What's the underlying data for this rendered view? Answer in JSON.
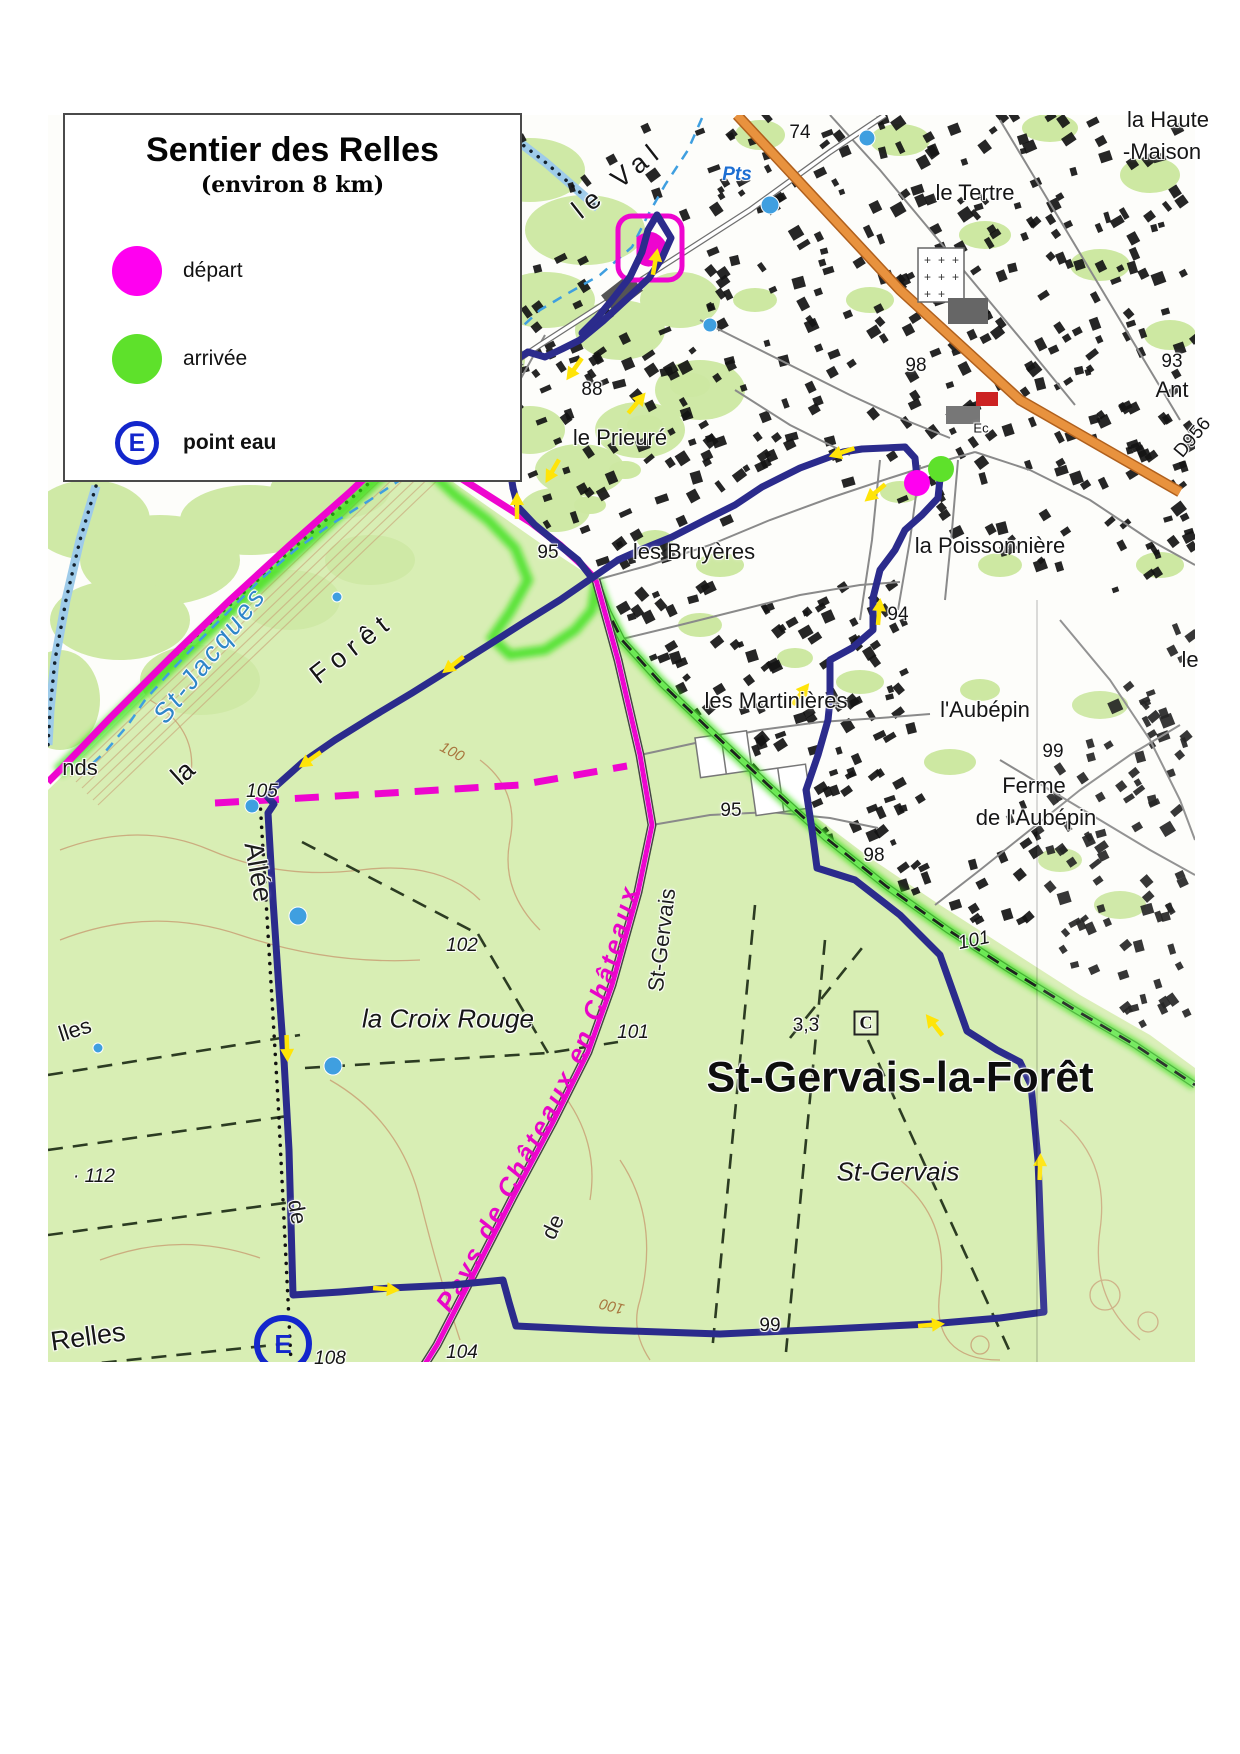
{
  "legend": {
    "title": "Sentier des Relles",
    "subtitle": "(environ 8 km)",
    "items": [
      {
        "symbol": "circle",
        "color": "#ff00f0",
        "label": "départ"
      },
      {
        "symbol": "circle",
        "color": "#5ee12b",
        "label": "arrivée"
      },
      {
        "symbol": "ring-E",
        "color": "#1326cc",
        "letter": "E",
        "label": "point eau"
      }
    ]
  },
  "map": {
    "colors": {
      "route": "#2b2b8c",
      "trail_magenta": "#ee05cf",
      "highlight_green": "#2fe00a",
      "forest": "#d8eeb4",
      "road_orange": "#e8923e",
      "water_blue": "#3f9fe0",
      "arrow_yellow": "#ffe408",
      "depart": "#ff00f0",
      "arrivee": "#5ee12b",
      "water_point_blue": "#1326cc"
    },
    "magenta_label": "Pays de Châteaux en Châteaux",
    "labels": [
      {
        "text": "le Val",
        "x": 618,
        "y": 180,
        "rot": -38,
        "cls": "place-lg ls"
      },
      {
        "text": "Pts",
        "x": 737,
        "y": 175,
        "rot": 0,
        "cls": "water"
      },
      {
        "text": "le Tertre",
        "x": 975,
        "y": 193,
        "rot": 0,
        "cls": "place"
      },
      {
        "text": "la Haute",
        "x": 1168,
        "y": 120,
        "rot": 0,
        "cls": "place"
      },
      {
        "text": "-Maison",
        "x": 1162,
        "y": 152,
        "rot": 0,
        "cls": "place"
      },
      {
        "text": "74",
        "x": 800,
        "y": 133,
        "rot": 0,
        "cls": "spot"
      },
      {
        "text": "98",
        "x": 916,
        "y": 366,
        "rot": 0,
        "cls": "spot"
      },
      {
        "text": "93",
        "x": 1172,
        "y": 362,
        "rot": 0,
        "cls": "spot"
      },
      {
        "text": "Ant",
        "x": 1172,
        "y": 390,
        "rot": 0,
        "cls": "place"
      },
      {
        "text": "D956",
        "x": 1193,
        "y": 438,
        "rot": -50,
        "cls": "spot"
      },
      {
        "text": "Ec",
        "x": 981,
        "y": 428,
        "rot": 0,
        "cls": "tiny"
      },
      {
        "text": "le Prieuré",
        "x": 620,
        "y": 438,
        "rot": 0,
        "cls": "place"
      },
      {
        "text": "88",
        "x": 592,
        "y": 390,
        "rot": 0,
        "cls": "spot"
      },
      {
        "text": "les Bruyères",
        "x": 694,
        "y": 552,
        "rot": 0,
        "cls": "place"
      },
      {
        "text": "95",
        "x": 548,
        "y": 553,
        "rot": 0,
        "cls": "spot"
      },
      {
        "text": "la Poissonnière",
        "x": 990,
        "y": 546,
        "rot": 0,
        "cls": "place"
      },
      {
        "text": "les Martinières",
        "x": 776,
        "y": 701,
        "rot": 0,
        "cls": "place"
      },
      {
        "text": "94",
        "x": 898,
        "y": 615,
        "rot": 0,
        "cls": "spot"
      },
      {
        "text": "l'Aubépin",
        "x": 985,
        "y": 710,
        "rot": 0,
        "cls": "place"
      },
      {
        "text": "99",
        "x": 1053,
        "y": 752,
        "rot": 0,
        "cls": "spot"
      },
      {
        "text": "Ferme",
        "x": 1034,
        "y": 786,
        "rot": 0,
        "cls": "place"
      },
      {
        "text": "de l'Aubépin",
        "x": 1036,
        "y": 818,
        "rot": 0,
        "cls": "place"
      },
      {
        "text": "98",
        "x": 874,
        "y": 856,
        "rot": 0,
        "cls": "spot"
      },
      {
        "text": "95",
        "x": 731,
        "y": 811,
        "rot": 0,
        "cls": "spot"
      },
      {
        "text": "101",
        "x": 974,
        "y": 941,
        "rot": -12,
        "cls": "spot-i"
      },
      {
        "text": "St-Gervais",
        "x": 662,
        "y": 940,
        "rot": -83,
        "cls": "roadname"
      },
      {
        "text": "de",
        "x": 553,
        "y": 1227,
        "rot": -65,
        "cls": "roadname"
      },
      {
        "text": "la Croix Rouge",
        "x": 448,
        "y": 1019,
        "rot": 0,
        "cls": "place-i"
      },
      {
        "text": "101",
        "x": 633,
        "y": 1033,
        "rot": 0,
        "cls": "spot-i"
      },
      {
        "text": "3,3",
        "x": 806,
        "y": 1026,
        "rot": 0,
        "cls": "spot"
      },
      {
        "text": "C",
        "x": 866,
        "y": 1023,
        "rot": 0,
        "cls": "cbox"
      },
      {
        "text": "St-Gervais-la-Forêt",
        "x": 900,
        "y": 1078,
        "rot": 0,
        "cls": "town"
      },
      {
        "text": "St-Gervais",
        "x": 898,
        "y": 1172,
        "rot": 0,
        "cls": "place-i"
      },
      {
        "text": "St-Jacques",
        "x": 210,
        "y": 655,
        "rot": -52,
        "cls": "water-lg"
      },
      {
        "text": "Forêt",
        "x": 352,
        "y": 648,
        "rot": -38,
        "cls": "place-lg ls"
      },
      {
        "text": "la",
        "x": 183,
        "y": 773,
        "rot": -42,
        "cls": "place-lg"
      },
      {
        "text": "nds",
        "x": 80,
        "y": 768,
        "rot": 0,
        "cls": "place"
      },
      {
        "text": "105",
        "x": 262,
        "y": 792,
        "rot": 0,
        "cls": "spot-i"
      },
      {
        "text": "Allée",
        "x": 258,
        "y": 872,
        "rot": 80,
        "cls": "roadname-lg"
      },
      {
        "text": "102",
        "x": 462,
        "y": 946,
        "rot": 0,
        "cls": "spot-i"
      },
      {
        "text": "· 112",
        "x": 94,
        "y": 1177,
        "rot": 0,
        "cls": "spot-i"
      },
      {
        "text": "lles",
        "x": 75,
        "y": 1030,
        "rot": -18,
        "cls": "place"
      },
      {
        "text": "de",
        "x": 297,
        "y": 1212,
        "rot": 80,
        "cls": "roadname"
      },
      {
        "text": "Relles",
        "x": 88,
        "y": 1337,
        "rot": -8,
        "cls": "place-lg"
      },
      {
        "text": "108",
        "x": 330,
        "y": 1359,
        "rot": 0,
        "cls": "spot-i"
      },
      {
        "text": "104",
        "x": 462,
        "y": 1353,
        "rot": 0,
        "cls": "spot-i"
      },
      {
        "text": "100",
        "x": 612,
        "y": 1306,
        "rot": 195,
        "cls": "contour"
      },
      {
        "text": "99",
        "x": 770,
        "y": 1326,
        "rot": 0,
        "cls": "spot"
      },
      {
        "text": "100",
        "x": 452,
        "y": 752,
        "rot": 28,
        "cls": "contour"
      },
      {
        "text": "le",
        "x": 1190,
        "y": 660,
        "rot": 0,
        "cls": "place"
      }
    ],
    "route": {
      "color": "#2b2b8c",
      "segments": [
        [
          [
            905,
            447
          ],
          [
            862,
            449
          ],
          [
            843,
            452
          ],
          [
            800,
            468
          ],
          [
            762,
            487
          ],
          [
            735,
            505
          ],
          [
            705,
            520
          ],
          [
            672,
            537
          ],
          [
            645,
            548
          ],
          [
            618,
            560
          ],
          [
            592,
            578
          ],
          [
            560,
            600
          ],
          [
            523,
            623
          ],
          [
            487,
            646
          ],
          [
            452,
            668
          ],
          [
            412,
            693
          ],
          [
            372,
            717
          ],
          [
            335,
            740
          ],
          [
            303,
            762
          ],
          [
            266,
            795
          ],
          [
            274,
            804
          ],
          [
            268,
            813
          ],
          [
            273,
            900
          ],
          [
            279,
            990
          ],
          [
            284,
            1060
          ],
          [
            289,
            1150
          ],
          [
            293,
            1295
          ],
          [
            340,
            1292
          ],
          [
            390,
            1288
          ],
          [
            452,
            1285
          ],
          [
            503,
            1280
          ],
          [
            509,
            1302
          ],
          [
            516,
            1326
          ],
          [
            600,
            1330
          ],
          [
            720,
            1334
          ],
          [
            830,
            1329
          ],
          [
            930,
            1324
          ],
          [
            1000,
            1318
          ],
          [
            1044,
            1312
          ],
          [
            1041,
            1240
          ],
          [
            1038,
            1160
          ],
          [
            1031,
            1085
          ],
          [
            1020,
            1062
          ],
          [
            997,
            1050
          ],
          [
            967,
            1031
          ],
          [
            940,
            955
          ],
          [
            900,
            915
          ],
          [
            855,
            880
          ],
          [
            817,
            868
          ],
          [
            812,
            830
          ],
          [
            806,
            790
          ],
          [
            818,
            755
          ],
          [
            828,
            720
          ],
          [
            830,
            700
          ],
          [
            830,
            660
          ],
          [
            852,
            648
          ],
          [
            873,
            630
          ],
          [
            873,
            598
          ],
          [
            880,
            570
          ],
          [
            895,
            550
          ],
          [
            905,
            530
          ],
          [
            922,
            515
          ],
          [
            938,
            498
          ],
          [
            941,
            469
          ]
        ],
        [
          [
            513,
            488
          ],
          [
            509,
            462
          ],
          [
            504,
            436
          ],
          [
            497,
            414
          ],
          [
            491,
            391
          ],
          [
            497,
            373
          ],
          [
            512,
            362
          ],
          [
            528,
            352
          ]
        ],
        [
          [
            513,
            488
          ],
          [
            518,
            507
          ],
          [
            535,
            525
          ],
          [
            558,
            544
          ],
          [
            578,
            560
          ],
          [
            592,
            578
          ]
        ],
        [
          [
            528,
            352
          ],
          [
            545,
            357
          ],
          [
            562,
            349
          ],
          [
            580,
            340
          ],
          [
            603,
            321
          ],
          [
            629,
            297
          ],
          [
            649,
            278
          ],
          [
            662,
            258
          ],
          [
            671,
            238
          ],
          [
            657,
            215
          ]
        ],
        [
          [
            657,
            215
          ],
          [
            648,
            230
          ],
          [
            642,
            252
          ],
          [
            630,
            277
          ],
          [
            612,
            300
          ],
          [
            597,
            318
          ],
          [
            582,
            333
          ]
        ],
        [
          [
            905,
            447
          ],
          [
            915,
            458
          ],
          [
            917,
            478
          ]
        ]
      ],
      "arrows": [
        [
          655,
          263,
          10
        ],
        [
          575,
          368,
          215
        ],
        [
          636,
          404,
          40
        ],
        [
          553,
          470,
          210
        ],
        [
          517,
          507,
          0
        ],
        [
          843,
          452,
          252
        ],
        [
          876,
          492,
          230
        ],
        [
          800,
          695,
          38
        ],
        [
          879,
          613,
          5
        ],
        [
          454,
          664,
          232
        ],
        [
          311,
          759,
          235
        ],
        [
          287,
          1047,
          178
        ],
        [
          385,
          1289,
          95
        ],
        [
          930,
          1325,
          85
        ],
        [
          1040,
          1168,
          2
        ],
        [
          935,
          1026,
          322
        ]
      ]
    },
    "markers": {
      "depart": {
        "x": 917,
        "y": 483,
        "r": 13
      },
      "arrivee": {
        "x": 941,
        "y": 469,
        "r": 13
      },
      "water_point": {
        "letter": "E",
        "x": 283,
        "y": 1344,
        "r": 26
      }
    },
    "water_dots": [
      [
        770,
        205,
        9
      ],
      [
        867,
        138,
        8
      ],
      [
        710,
        325,
        7
      ],
      [
        337,
        597,
        5
      ],
      [
        252,
        806,
        7
      ],
      [
        298,
        916,
        9
      ],
      [
        333,
        1066,
        9
      ],
      [
        98,
        1048,
        5
      ]
    ]
  }
}
